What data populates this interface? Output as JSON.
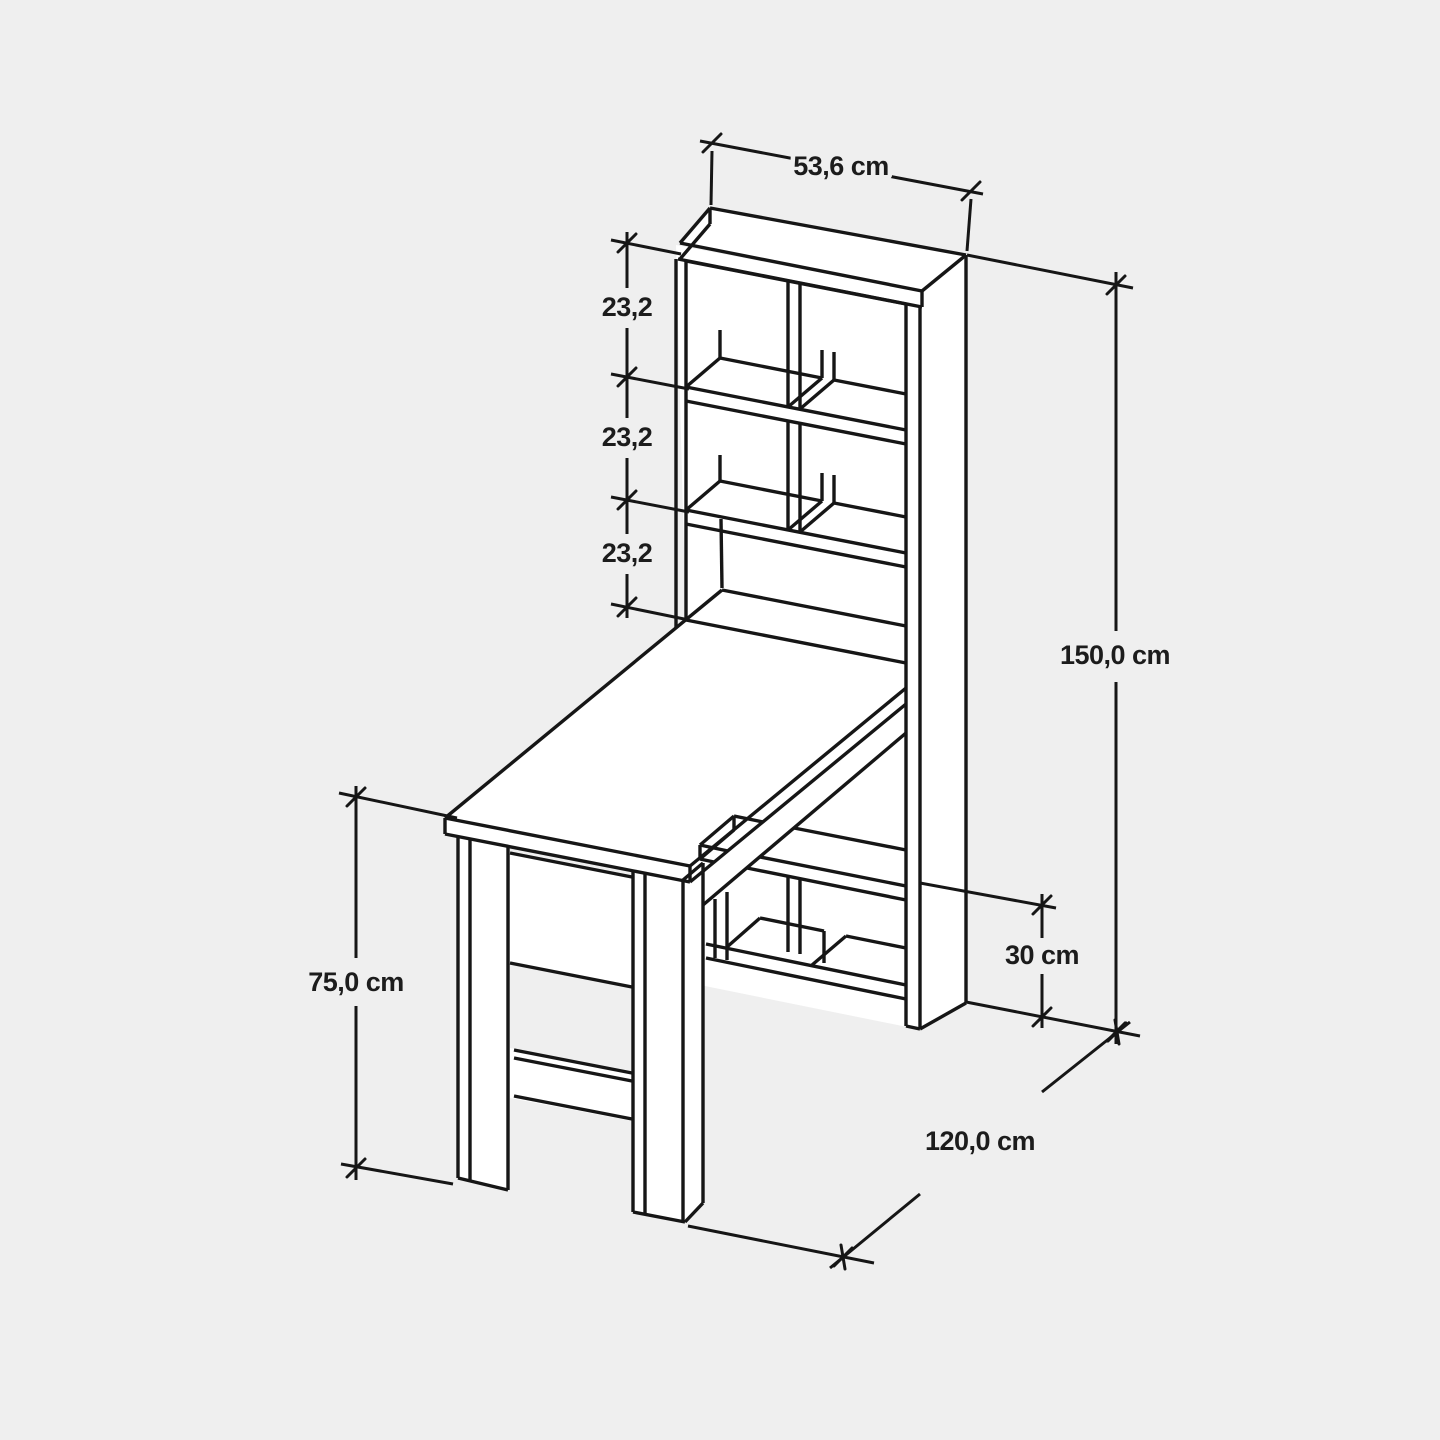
{
  "colors": {
    "background": "#efefef",
    "line": "#161616",
    "text": "#1c1c1c",
    "panel": "#ffffff"
  },
  "drawing": {
    "subject": "desk-with-bookshelf-technical-drawing",
    "unit": "cm"
  },
  "dimensions": {
    "top_width_label": "53,6 cm",
    "shelf_gap_labels": [
      "23,2",
      "23,2",
      "23,2"
    ],
    "total_height_label": "150,0 cm",
    "bottom_cubby_height_label": "30 cm",
    "desk_depth_label": "120,0 cm",
    "desk_height_label": "75,0 cm"
  }
}
